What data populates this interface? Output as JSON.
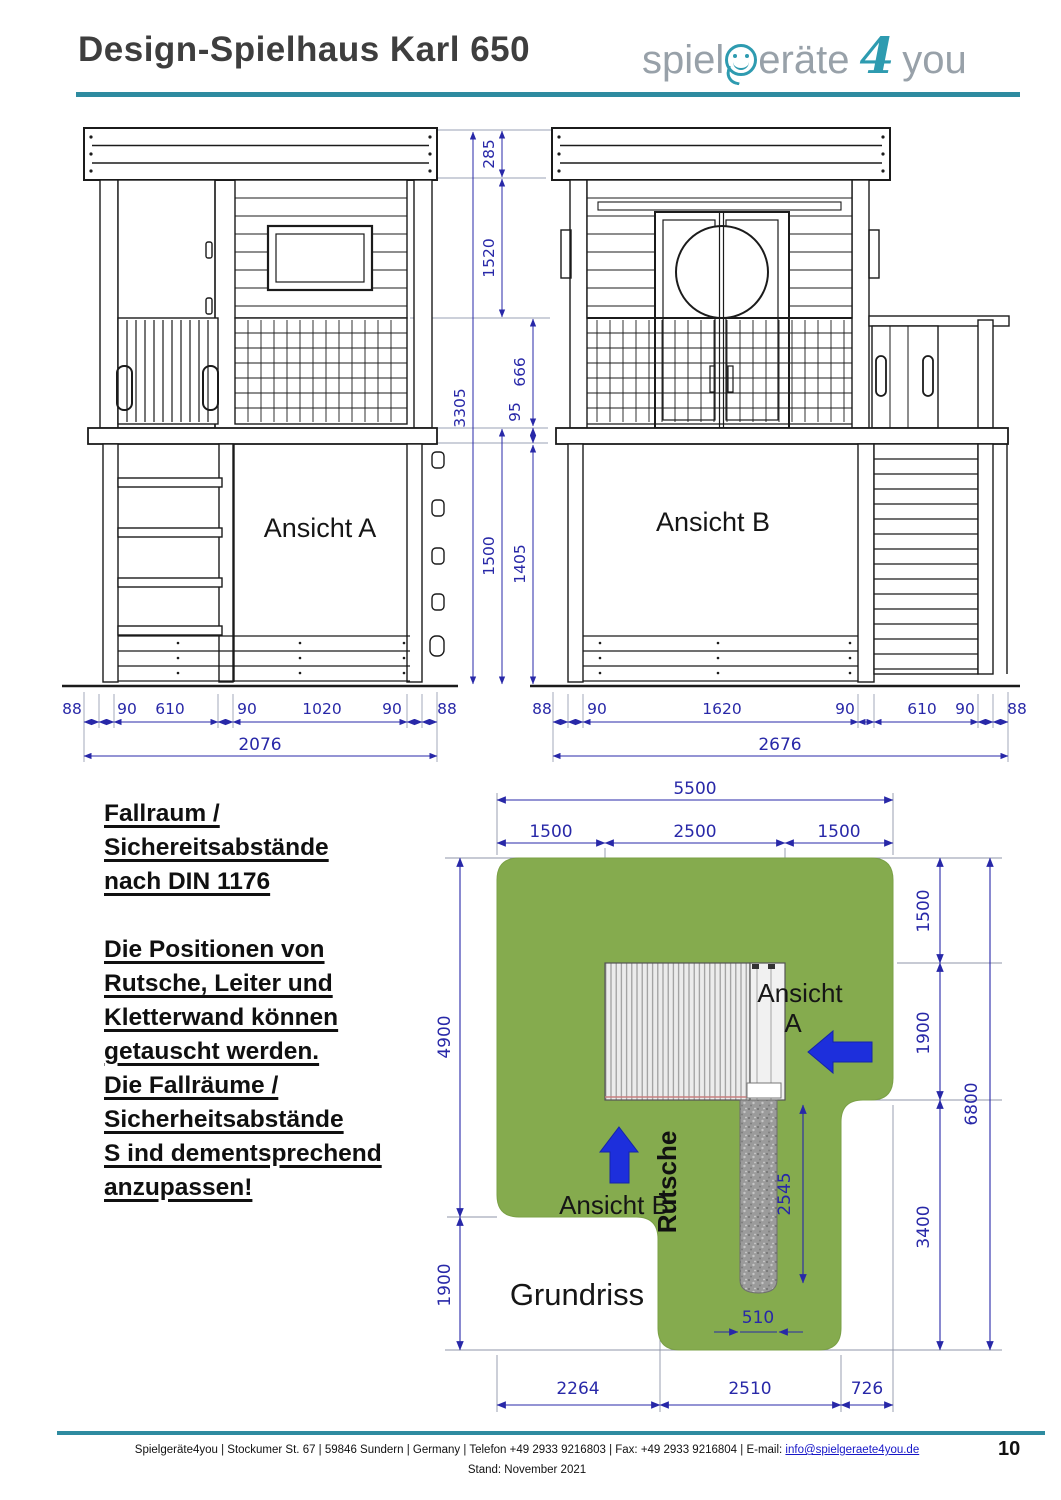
{
  "header": {
    "title": "Design-Spielhaus Karl 650",
    "logo": {
      "pre": "spiel",
      "post": "eräte",
      "four": "4",
      "you": "you"
    }
  },
  "elevations": {
    "view_a": {
      "label": "Ansicht A",
      "widths": [
        "88",
        "90",
        "610",
        "90",
        "1020",
        "90",
        "88"
      ],
      "total": "2076"
    },
    "view_b": {
      "label": "Ansicht B",
      "widths": [
        "88",
        "90",
        "1620",
        "90",
        "610",
        "90",
        "88"
      ],
      "total": "2676"
    },
    "heights": {
      "roof": "285",
      "upper": "1520",
      "railing": "666",
      "platform": "95",
      "total": "3305",
      "lower": "1500",
      "lower_inner": "1405"
    }
  },
  "note": {
    "para1": [
      "Fallraum /",
      "Sichereitsabstände",
      "nach DIN 1176"
    ],
    "para2": [
      "Die Positionen von",
      "Rutsche, Leiter und",
      "Kletterwand können",
      "getauscht werden.",
      "Die Fallräume /",
      "Sicherheitsabstände",
      "S ind dementsprechend",
      "anzupassen!"
    ]
  },
  "plan": {
    "title": "Grundriss",
    "slide_label": "Rutsche",
    "view_a_line1": "Ansicht",
    "view_a_line2": "A",
    "view_b_label": "Ansicht B",
    "dims": {
      "top_total": "5500",
      "top": [
        "1500",
        "2500",
        "1500"
      ],
      "left": [
        "4900",
        "1900"
      ],
      "right": [
        "1500",
        "1900",
        "3400"
      ],
      "right_total": "6800",
      "slide_length": "2545",
      "slide_width": "510",
      "bottom": [
        "2264",
        "2510",
        "726"
      ]
    }
  },
  "footer": {
    "line1_prefix": "Spielgeräte4you |  Stockumer St. 67 |  59846 Sundern |  Germany | Telefon +49 2933 9216803  | Fax: +49 2933 9216804 | E-mail: ",
    "email": "info@spielgeraete4you.de",
    "stand": "Stand: November 2021",
    "page": "10"
  },
  "colors": {
    "accent_teal": "#2e8ba0",
    "logo_teal": "#2e9bb0",
    "dimension_blue": "#2828a8",
    "safety_green": "#85ab4e",
    "arrow_blue": "#1d2fdc",
    "slide_gray": "#9b9b9b"
  }
}
